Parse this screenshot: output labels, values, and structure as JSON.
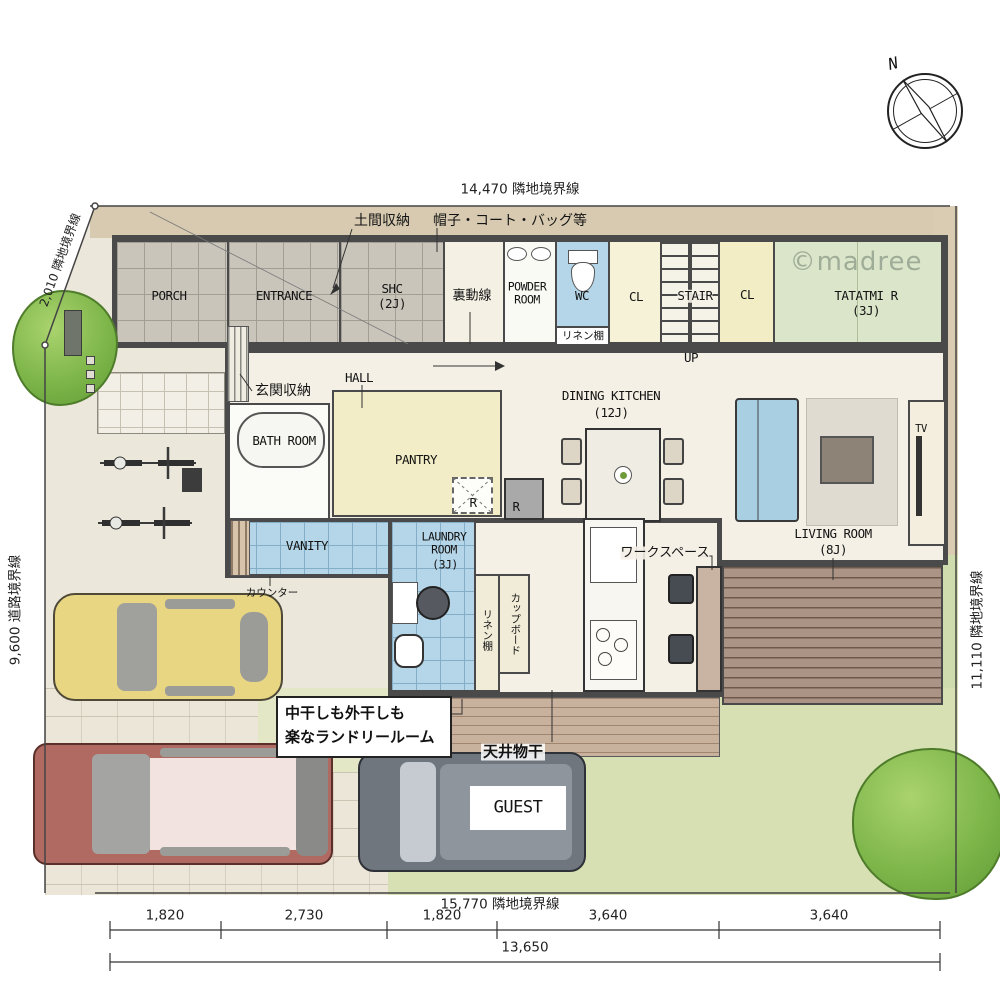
{
  "boundaries": {
    "top": "14,470 隣地境界線",
    "top_left": "2,010 隣地境界線",
    "left": "9,600 道路境界線",
    "right": "11,110 隣地境界線",
    "bottom": "15,770 隣地境界線"
  },
  "dimensions": {
    "segments": [
      "1,820",
      "2,730",
      "1,820",
      "3,640",
      "3,640"
    ],
    "total": "13,650"
  },
  "compass": {
    "north": "N"
  },
  "watermark": "©madree",
  "rooms": {
    "porch": "PORCH",
    "entrance": "ENTRANCE",
    "shc": "SHC",
    "shc_size": "(2J)",
    "ura_dousen": "裏動線",
    "powder1": "POWDER",
    "powder2": "ROOM",
    "wc": "WC",
    "linen_wc": "リネン棚",
    "cl1": "CL",
    "stair": "STAIR",
    "up": "UP",
    "cl2": "CL",
    "tatami": "TATATMI R",
    "tatami_size": "(3J)",
    "hall": "HALL",
    "genkan_shunou": "玄関収納",
    "bath": "BATH ROOM",
    "pantry": "PANTRY",
    "fridge_dashed": "R",
    "fridge_solid": "R",
    "dining": "DINING KITCHEN",
    "dining_size": "(12J)",
    "living": "LIVING ROOM",
    "living_size": "(8J)",
    "tv": "TV",
    "vanity": "VANITY",
    "counter": "カウンター",
    "laundry1": "LAUNDRY",
    "laundry2": "ROOM",
    "laundry_size": "(3J)",
    "linen_laundry": "リネン棚",
    "cupboard": "カップボード",
    "workspace": "ワークスペース",
    "guest_car": "GUEST"
  },
  "annotations": {
    "doma_shunou": "土間収納",
    "hat_coat_bag": "帽子・コート・バッグ等",
    "laundry_note1": "中干しも外干しも",
    "laundry_note2": "楽なランドリールーム",
    "ceiling_drying": "天井物干"
  },
  "colors": {
    "wall": "#4a4a4a",
    "tile_gray": "#c9c5bb",
    "water_blue": "#b5d6e8",
    "closet_yellow": "#f2edc4",
    "tatami_green": "#dbe5c9",
    "pantry_yellow": "#f2edc6",
    "deck_brown": "#ab9485",
    "lawn_green": "#d7e0b2",
    "ground_tan": "#d7cab0",
    "car_yellow": "#e9d683",
    "car_red": "#b06a62",
    "car_gray": "#70767e"
  }
}
